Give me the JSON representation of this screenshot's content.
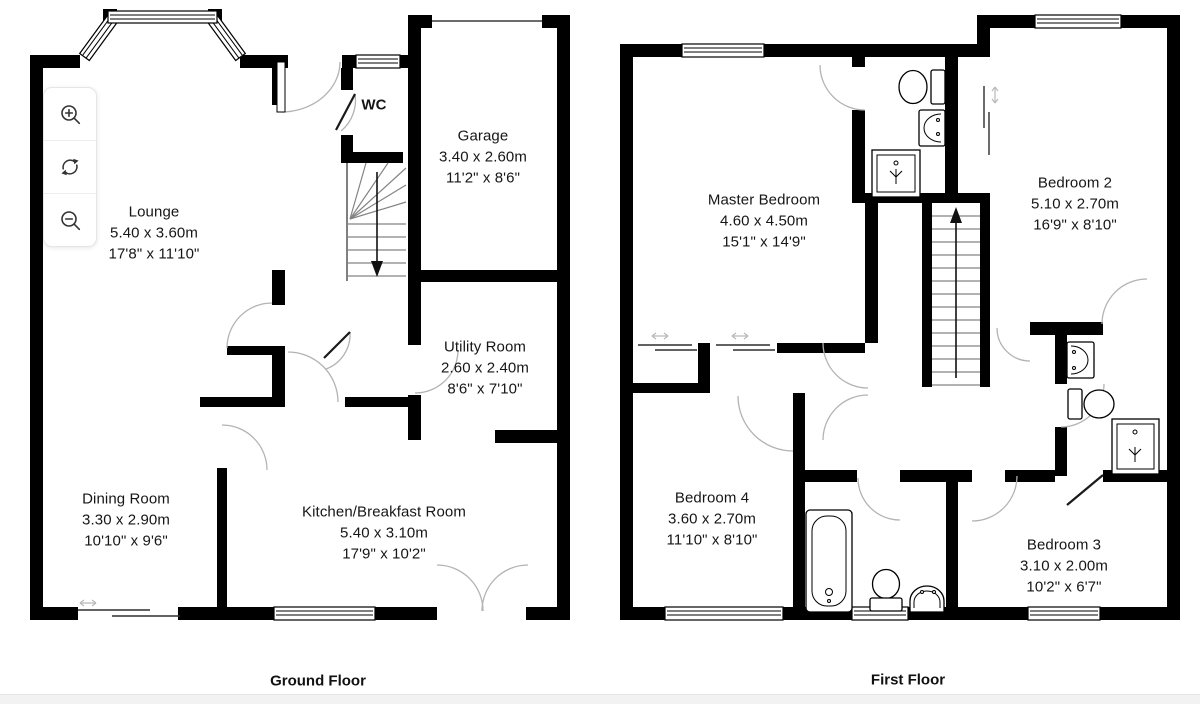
{
  "page": {
    "background": "#ffffff",
    "footer_bar_color": "#f2f2f2",
    "wall_color": "#000000",
    "door_arc_color": "#b3b3b3"
  },
  "toolbar": {
    "buttons": [
      {
        "label": "zoom in",
        "icon": "magnifier-plus-icon"
      },
      {
        "label": "rotate",
        "icon": "rotate-arrows-icon"
      },
      {
        "label": "zoom out",
        "icon": "magnifier-minus-icon"
      }
    ]
  },
  "floors": [
    {
      "caption": "Ground Floor",
      "rooms": [
        {
          "name": "Lounge",
          "metric": "5.40 x 3.60m",
          "imperial": "17'8\" x 11'10\""
        },
        {
          "name": "WC",
          "metric": "",
          "imperial": ""
        },
        {
          "name": "Garage",
          "metric": "3.40 x 2.60m",
          "imperial": "11'2\" x 8'6\""
        },
        {
          "name": "Utility Room",
          "metric": "2.60 x 2.40m",
          "imperial": "8'6\" x 7'10\""
        },
        {
          "name": "Dining Room",
          "metric": "3.30 x 2.90m",
          "imperial": "10'10\" x 9'6\""
        },
        {
          "name": "Kitchen/Breakfast Room",
          "metric": "5.40 x 3.10m",
          "imperial": "17'9\" x 10'2\""
        }
      ]
    },
    {
      "caption": "First Floor",
      "rooms": [
        {
          "name": "Master Bedroom",
          "metric": "4.60 x 4.50m",
          "imperial": "15'1\" x 14'9\""
        },
        {
          "name": "Bedroom 2",
          "metric": "5.10 x 2.70m",
          "imperial": "16'9\" x 8'10\""
        },
        {
          "name": "Bedroom 4",
          "metric": "3.60 x 2.70m",
          "imperial": "11'10\" x 8'10\""
        },
        {
          "name": "Bedroom 3",
          "metric": "3.10 x 2.00m",
          "imperial": "10'2\" x 6'7\""
        }
      ]
    }
  ]
}
